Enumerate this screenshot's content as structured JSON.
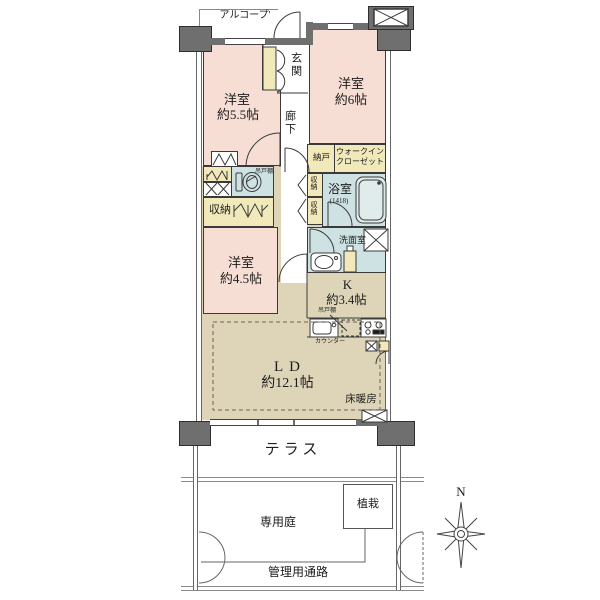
{
  "plan": {
    "labels": {
      "alcove": "アルコープ'",
      "entrance": "玄関",
      "corridor": "廊下",
      "bedroom1_name": "洋室",
      "bedroom1_size": "約5.5帖",
      "bedroom2_name": "洋室",
      "bedroom2_size": "約6帖",
      "bedroom3_name": "洋室",
      "bedroom3_size": "約4.5帖",
      "storeroom": "納戸",
      "wic_line1": "ウォークイン",
      "wic_line2": "クローゼット",
      "closet": "収納",
      "closet_upper": "収納",
      "closet_lower": "収納",
      "bath": "浴室",
      "bath_size": "(1418)",
      "washroom": "洗面室",
      "kitchen": "K",
      "kitchen_size": "約3.4帖",
      "living": "LD",
      "living_size": "約12.1帖",
      "floor_heating": "床暖房",
      "cupboard_toilet": "吊戸棚",
      "cupboard_kitchen": "吊戸棚",
      "counter": "カウンター",
      "terrace": "テラス",
      "private_garden": "専用庭",
      "planting": "植栽",
      "service_passage": "管理用通路",
      "compass_n": "N"
    },
    "colors": {
      "wall": "#6f6f6f",
      "bedroom_pink": "#f7ded4",
      "storage_yellow": "#f1e9ba",
      "wet_area_blue": "#cfe2e3",
      "living_beige": "#ded5b9",
      "linework": "#3a3a3a"
    }
  }
}
